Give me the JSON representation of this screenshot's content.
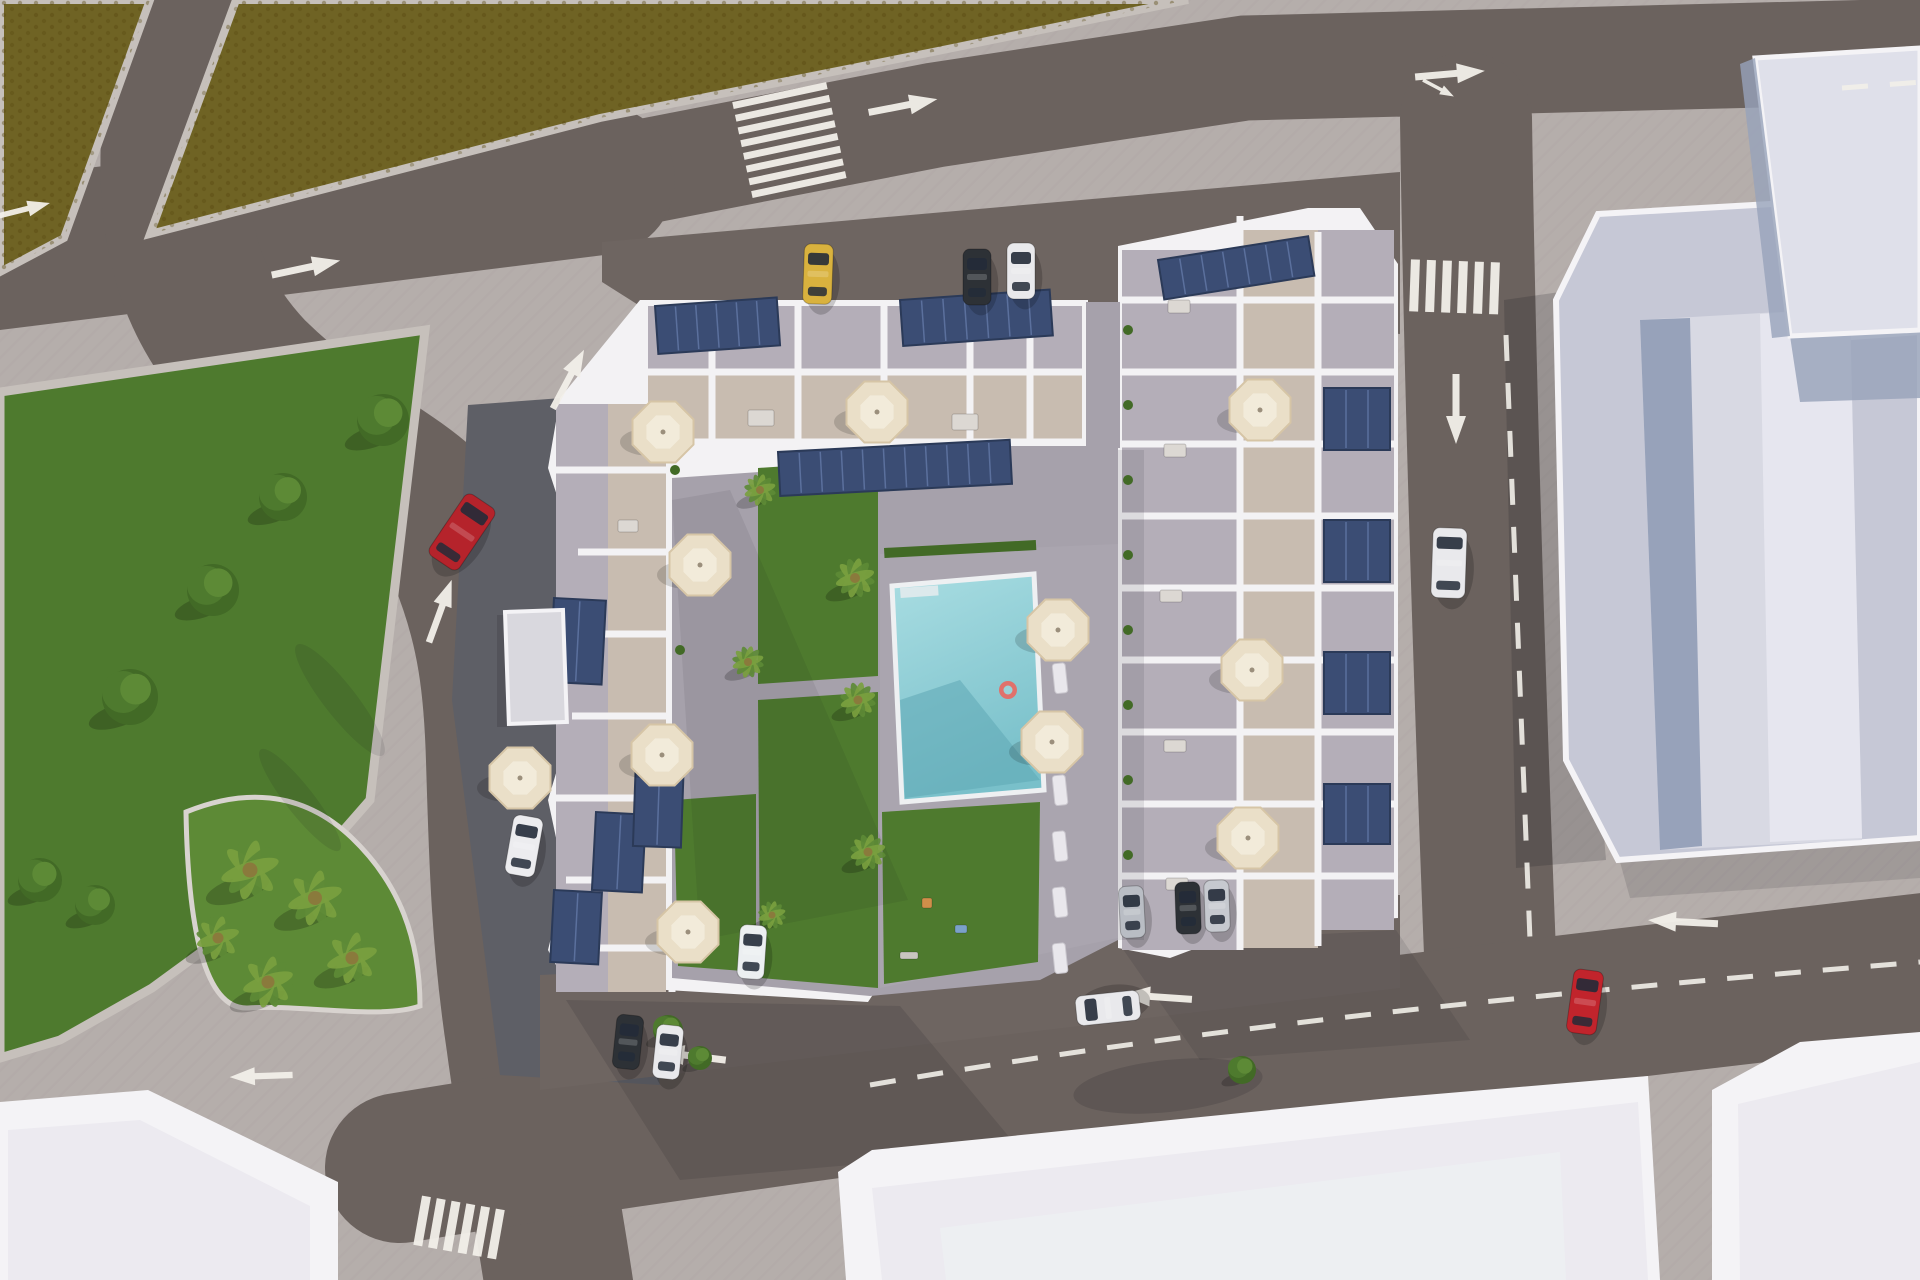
{
  "scene": {
    "type": "aerial-3d-architectural-render",
    "description": "Top-down aerial 3D rendering of a residential apartment complex with rooftop terraces, solar panels and cream parasols arranged around a central courtyard with a turquoise swimming pool, lawns and palm trees; surrounded by streets with white road markings and cars, a green public park, a palm island, olive-coloured fields and neighbouring grey buildings."
  },
  "palette": {
    "sidewalk": "#b5aeab",
    "sidewalk-line": "#9a9390",
    "road": "#6b625e",
    "road-apron": "#6e6561",
    "road-apron-shadow": "#5e5f66",
    "marking": "#f2efe9",
    "field": "#6f6324",
    "field-dot": "#57490f",
    "grass": "#4e7a2e",
    "grass-bright": "#5d8a36",
    "grass-dark": "#426a26",
    "palm": "#7aa03f",
    "pool": "#9ad2d8",
    "pool-deep": "#79c0ca",
    "pool-shadow": "#5ea8b4",
    "building-white": "#f3f2f4",
    "terrace": "#c8bcb0",
    "deck": "#b4aeb8",
    "paving": "#a6a1ab",
    "pool-deck": "#aaa5af",
    "solar": "#3b4d74",
    "solar-line": "#6379a8",
    "solar-edge": "#2b3a58",
    "umbrella": "#eadfc8",
    "umbrella-edge": "#d6c5a6",
    "shed": "#d9d8de",
    "right-wall": "#c6c8d6",
    "right-tower": "#d8d9e3",
    "right-tower-light": "#e6e6ef",
    "right-face-shadow": "#97a2ba",
    "annex": "#dfe0ea",
    "annex-shadow": "#9aa5bb",
    "white-rim": "#f4f3f6",
    "roof-light": "#eceaf0",
    "roof-inner": "#edeff2",
    "car-window": "#232b38",
    "furniture": "#dcd8d3"
  },
  "vehicles": [
    {
      "name": "red-car-west-road",
      "x": 462,
      "y": 532,
      "rot": 34,
      "len": 74,
      "wid": 36,
      "body": "#b5232b"
    },
    {
      "name": "white-car-east-road",
      "x": 1449,
      "y": 563,
      "rot": 2,
      "len": 70,
      "wid": 34,
      "body": "#e9e9ec"
    },
    {
      "name": "red-car-south-road",
      "x": 1585,
      "y": 1002,
      "rot": 8,
      "len": 64,
      "wid": 30,
      "body": "#c1242c"
    },
    {
      "name": "white-car-south-road",
      "x": 1108,
      "y": 1008,
      "rot": -96,
      "len": 64,
      "wid": 30,
      "body": "#e9e9ec"
    },
    {
      "name": "yellow-taxi-north-parking",
      "x": 818,
      "y": 274,
      "rot": 2,
      "len": 60,
      "wid": 29,
      "body": "#d9b23e"
    },
    {
      "name": "dark-car-north-parking",
      "x": 977,
      "y": 277,
      "rot": 0,
      "len": 56,
      "wid": 28,
      "body": "#2d3136"
    },
    {
      "name": "white-car-north-parking",
      "x": 1021,
      "y": 271,
      "rot": 0,
      "len": 56,
      "wid": 28,
      "body": "#e9e9ec"
    },
    {
      "name": "white-car-west-parking",
      "x": 524,
      "y": 846,
      "rot": 10,
      "len": 60,
      "wid": 30,
      "body": "#ececef"
    },
    {
      "name": "dark-car-south-parking",
      "x": 628,
      "y": 1042,
      "rot": 6,
      "len": 54,
      "wid": 27,
      "body": "#2d3136"
    },
    {
      "name": "white-car-south-parking",
      "x": 668,
      "y": 1052,
      "rot": 6,
      "len": 54,
      "wid": 27,
      "body": "#e9e9ec"
    },
    {
      "name": "white-car-south-parking-2",
      "x": 752,
      "y": 952,
      "rot": 4,
      "len": 54,
      "wid": 27,
      "body": "#eceff1"
    },
    {
      "name": "silver-car-southeast-parking",
      "x": 1132,
      "y": 912,
      "rot": -3,
      "len": 52,
      "wid": 25,
      "body": "#b9bdc4"
    },
    {
      "name": "dark-car-southeast-parking",
      "x": 1188,
      "y": 908,
      "rot": -2,
      "len": 52,
      "wid": 25,
      "body": "#2d3136"
    },
    {
      "name": "silver-car-southeast-parking-2",
      "x": 1217,
      "y": 906,
      "rot": -2,
      "len": 52,
      "wid": 25,
      "body": "#c6c9cf"
    }
  ],
  "umbrellas": [
    [
      663,
      432
    ],
    [
      877,
      412
    ],
    [
      700,
      565
    ],
    [
      662,
      755
    ],
    [
      688,
      932
    ],
    [
      520,
      778
    ],
    [
      1058,
      630
    ],
    [
      1052,
      742
    ],
    [
      1260,
      410
    ],
    [
      1252,
      670
    ],
    [
      1248,
      838
    ]
  ],
  "trees": [
    {
      "kind": "bush",
      "x": 383,
      "y": 420,
      "r": 26
    },
    {
      "kind": "bush",
      "x": 283,
      "y": 497,
      "r": 24
    },
    {
      "kind": "bush",
      "x": 213,
      "y": 590,
      "r": 26
    },
    {
      "kind": "bush",
      "x": 130,
      "y": 697,
      "r": 28
    },
    {
      "kind": "bush",
      "x": 40,
      "y": 880,
      "r": 22
    },
    {
      "kind": "bush",
      "x": 95,
      "y": 905,
      "r": 20
    },
    {
      "kind": "palm",
      "x": 250,
      "y": 870,
      "r": 30
    },
    {
      "kind": "palm",
      "x": 315,
      "y": 898,
      "r": 28
    },
    {
      "kind": "palm",
      "x": 352,
      "y": 958,
      "r": 26
    },
    {
      "kind": "palm",
      "x": 268,
      "y": 982,
      "r": 26
    },
    {
      "kind": "palm",
      "x": 218,
      "y": 938,
      "r": 22
    },
    {
      "kind": "palm",
      "x": 855,
      "y": 578,
      "r": 20
    },
    {
      "kind": "palm",
      "x": 858,
      "y": 700,
      "r": 18
    },
    {
      "kind": "palm",
      "x": 868,
      "y": 852,
      "r": 18
    },
    {
      "kind": "palm",
      "x": 760,
      "y": 490,
      "r": 16
    },
    {
      "kind": "palm",
      "x": 748,
      "y": 662,
      "r": 16
    },
    {
      "kind": "palm",
      "x": 772,
      "y": 915,
      "r": 14
    },
    {
      "kind": "bush",
      "x": 668,
      "y": 1030,
      "r": 15
    },
    {
      "kind": "bush",
      "x": 700,
      "y": 1058,
      "r": 12
    },
    {
      "kind": "bush",
      "x": 1242,
      "y": 1070,
      "r": 14
    }
  ],
  "planters": [
    [
      1128,
      330
    ],
    [
      1128,
      405
    ],
    [
      1128,
      480
    ],
    [
      1128,
      555
    ],
    [
      1128,
      630
    ],
    [
      1128,
      705
    ],
    [
      1128,
      780
    ],
    [
      1128,
      855
    ],
    [
      675,
      470
    ],
    [
      678,
      560
    ],
    [
      680,
      650
    ]
  ],
  "arrows": [
    {
      "x": 305,
      "y": 268,
      "rot": -12,
      "s": 1
    },
    {
      "x": 902,
      "y": 106,
      "rot": -11,
      "s": 1
    },
    {
      "x": 1449,
      "y": 74,
      "rot": -5,
      "s": 1
    },
    {
      "x": 1438,
      "y": 88,
      "rot": 28,
      "s": 0.5
    },
    {
      "x": 22,
      "y": 210,
      "rot": -14,
      "s": 0.8
    },
    {
      "x": 568,
      "y": 380,
      "rot": -62,
      "s": 0.95
    },
    {
      "x": 440,
      "y": 612,
      "rot": -70,
      "s": 0.95
    },
    {
      "x": 262,
      "y": 1076,
      "rot": 178,
      "s": 0.9
    },
    {
      "x": 692,
      "y": 1056,
      "rot": 187,
      "s": 1
    },
    {
      "x": 1158,
      "y": 997,
      "rot": 184,
      "s": 1
    },
    {
      "x": 1684,
      "y": 922,
      "rot": 183,
      "s": 1
    },
    {
      "x": 1456,
      "y": 408,
      "rot": 90,
      "s": 1
    }
  ],
  "crosswalks": [
    {
      "x": 790,
      "y": 143,
      "rot": -12,
      "mode": "stack",
      "count": 8,
      "len": 96,
      "thick": 7,
      "gap": 13
    },
    {
      "x": 1458,
      "y": 287,
      "rot": 2,
      "mode": "row",
      "count": 6,
      "len": 52,
      "thick": 9,
      "gap": 16
    },
    {
      "x": 462,
      "y": 1228,
      "rot": 10,
      "mode": "row",
      "count": 6,
      "len": 50,
      "thick": 9,
      "gap": 15
    }
  ],
  "dashes": [
    "M870,1085 C1200,1028 1520,995 1920,962",
    "M1506,335 L1530,940",
    "M1842,88 L1922,82"
  ],
  "solar_panels": [
    [
      655,
      306,
      122,
      48,
      -4
    ],
    [
      900,
      300,
      150,
      46,
      -4
    ],
    [
      1158,
      260,
      152,
      40,
      -9
    ],
    [
      778,
      452,
      232,
      44,
      -3
    ],
    [
      1324,
      388,
      66,
      62,
      0
    ],
    [
      1324,
      520,
      66,
      62,
      0
    ],
    [
      1324,
      652,
      66,
      62,
      0
    ],
    [
      1324,
      784,
      66,
      60,
      0
    ],
    [
      554,
      598,
      52,
      84,
      3
    ],
    [
      596,
      812,
      50,
      78,
      3
    ],
    [
      554,
      890,
      48,
      72,
      3
    ],
    [
      636,
      758,
      48,
      88,
      2
    ]
  ],
  "loungers": {
    "x": 1052,
    "y_start": 608,
    "step": 56,
    "count": 7,
    "w": 13,
    "h": 30,
    "rot": -6
  },
  "furniture": [
    {
      "x": 748,
      "y": 410,
      "w": 26,
      "h": 16
    },
    {
      "x": 952,
      "y": 414,
      "w": 26,
      "h": 16
    },
    {
      "x": 618,
      "y": 520,
      "w": 20,
      "h": 12
    },
    {
      "x": 1168,
      "y": 300,
      "w": 22,
      "h": 13
    },
    {
      "x": 1164,
      "y": 444,
      "w": 22,
      "h": 13
    },
    {
      "x": 1160,
      "y": 590,
      "w": 22,
      "h": 12
    },
    {
      "x": 1164,
      "y": 740,
      "w": 22,
      "h": 12
    },
    {
      "x": 1166,
      "y": 878,
      "w": 22,
      "h": 12
    },
    {
      "x": 922,
      "y": 898,
      "w": 10,
      "h": 10,
      "fill": "#cf8f4a"
    },
    {
      "x": 955,
      "y": 925,
      "w": 12,
      "h": 8,
      "fill": "#7ba1c9"
    },
    {
      "x": 900,
      "y": 952,
      "w": 18,
      "h": 7,
      "fill": "#c9c5c0"
    }
  ],
  "pool_float": {
    "x": 1008,
    "y": 690
  }
}
